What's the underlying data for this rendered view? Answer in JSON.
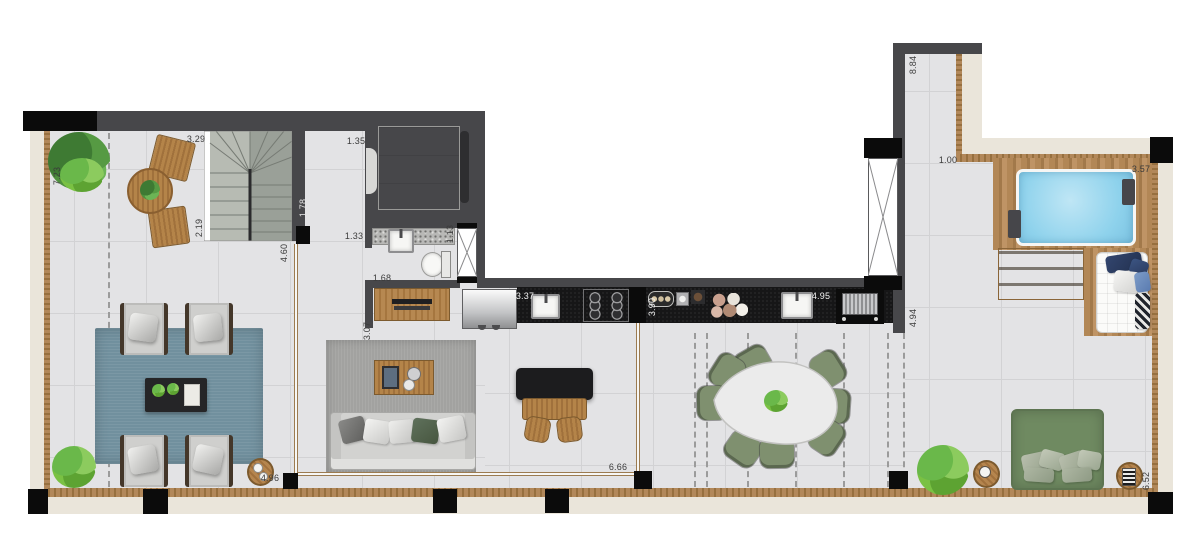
{
  "plan_title": "penthouse-floor-plan",
  "dimension_labels": [
    {
      "id": "terrace-top-width",
      "value": "3.29",
      "orientation": "horizontal"
    },
    {
      "id": "terrace-left-height",
      "value": "7.23",
      "orientation": "vertical"
    },
    {
      "id": "stair-run",
      "value": "2.19",
      "orientation": "vertical"
    },
    {
      "id": "hall-top",
      "value": "1.78",
      "orientation": "vertical"
    },
    {
      "id": "hall-mid",
      "value": "4.60",
      "orientation": "vertical"
    },
    {
      "id": "elevator-width",
      "value": "1.35",
      "orientation": "horizontal"
    },
    {
      "id": "bath-door",
      "value": "1.33",
      "orientation": "horizontal"
    },
    {
      "id": "bath-width",
      "value": "1.68",
      "orientation": "horizontal"
    },
    {
      "id": "bath-depth",
      "value": "1.13",
      "orientation": "vertical"
    },
    {
      "id": "hall-width",
      "value": "3.07",
      "orientation": "vertical"
    },
    {
      "id": "counter-left",
      "value": "3.37",
      "orientation": "horizontal"
    },
    {
      "id": "counter-mid",
      "value": "3.90",
      "orientation": "vertical"
    },
    {
      "id": "counter-right",
      "value": "4.95",
      "orientation": "horizontal"
    },
    {
      "id": "right-wall-lower",
      "value": "4.94",
      "orientation": "vertical"
    },
    {
      "id": "right-wall-upper",
      "value": "8.84",
      "orientation": "vertical"
    },
    {
      "id": "walkway-width",
      "value": "1.00",
      "orientation": "horizontal"
    },
    {
      "id": "pool-width",
      "value": "3.57",
      "orientation": "horizontal"
    },
    {
      "id": "terrace-bottom-left",
      "value": "4.96",
      "orientation": "horizontal"
    },
    {
      "id": "living-width",
      "value": "6.66",
      "orientation": "horizontal"
    },
    {
      "id": "right-terrace-height",
      "value": "6.52",
      "orientation": "vertical"
    }
  ],
  "colors": {
    "wall": "#47474a",
    "column": "#0b0b0b",
    "floor": "#e3e3e5",
    "tile_line": "#d2d2d4",
    "ledge": "#eae5da",
    "wood": "#a97c48",
    "wood_dark": "#7c5a2e",
    "deck": "#b28756",
    "counter": "#161617",
    "pool": "#8ed2ec",
    "rug_blue": "#71909e",
    "rug_gray": "#a2a2a0",
    "chair_green": "#7f906f",
    "daybed_green": "#6f8a61",
    "plant": "#53a23e",
    "sofa": "#d2d2d0",
    "marble": "#efefed",
    "label": "#3b3b3b",
    "glass_frame": "#9c7b50"
  }
}
